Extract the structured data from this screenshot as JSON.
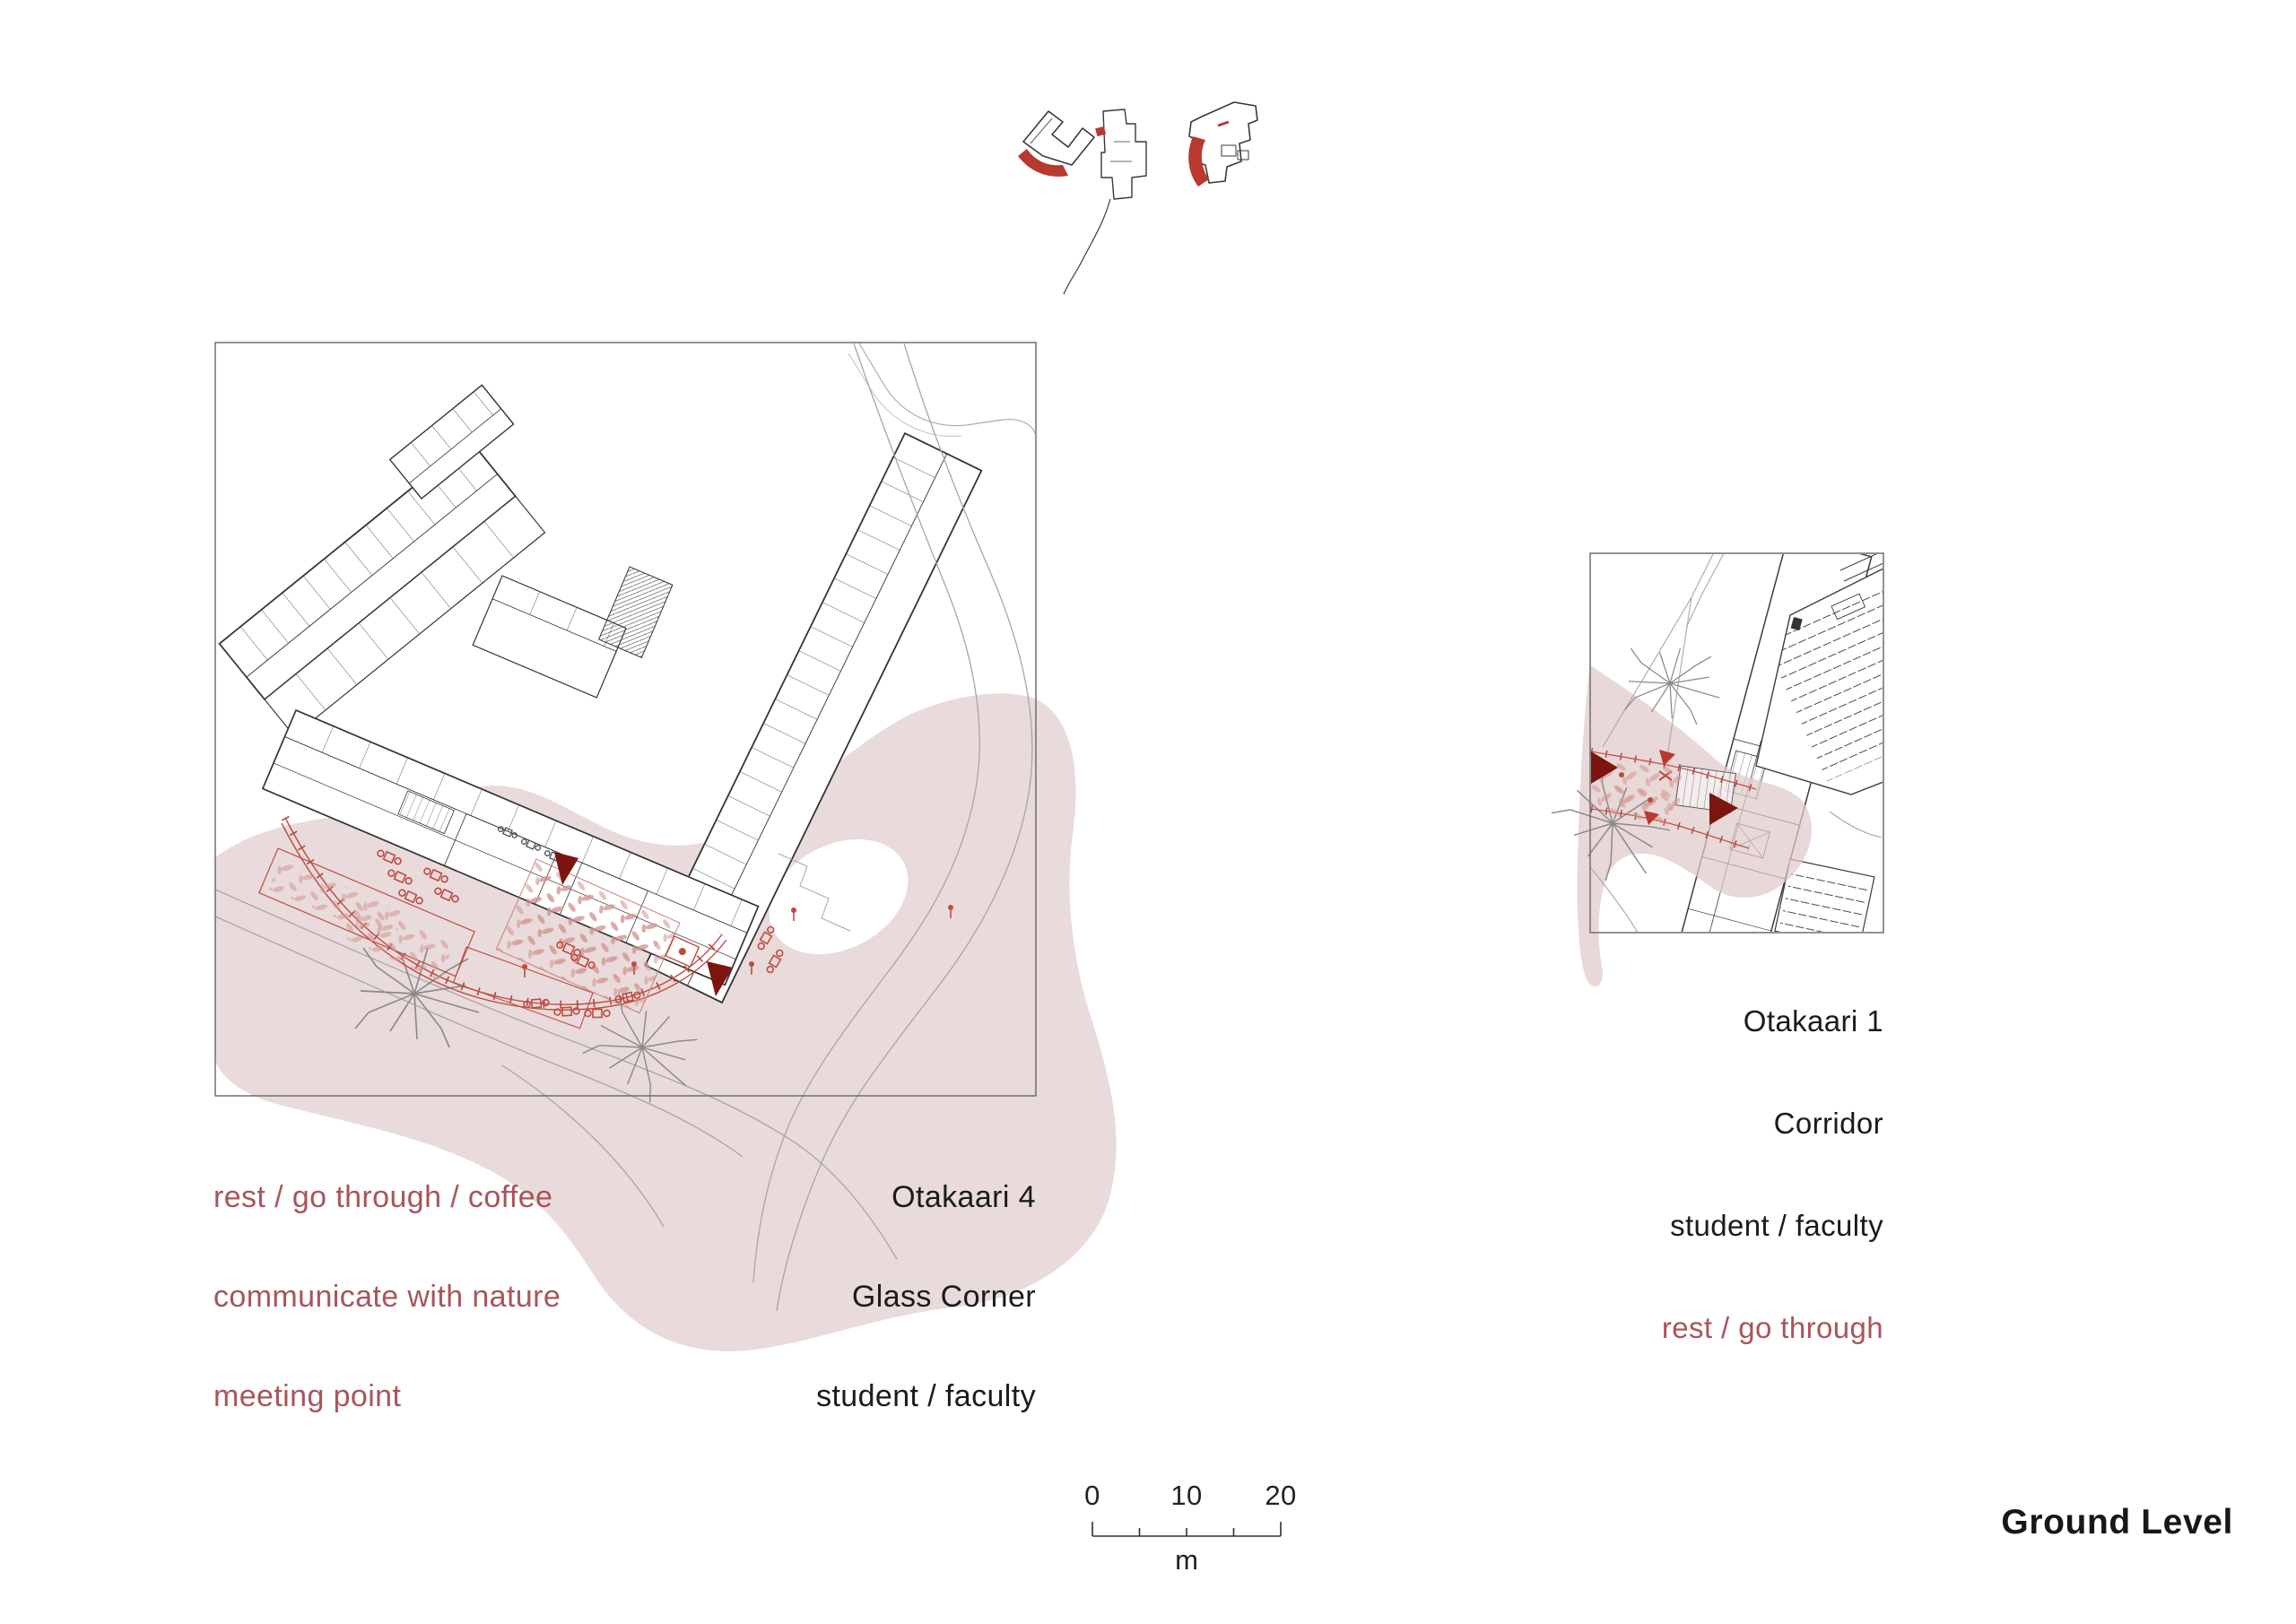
{
  "sheet": {
    "level_label": "Ground Level"
  },
  "plan_otakaari4": {
    "title": "Otakaari 4",
    "space": "Glass Corner",
    "users": "student / faculty",
    "activities": [
      "rest / go through / coffee",
      "communicate with nature",
      "meeting point"
    ]
  },
  "plan_otakaari1": {
    "title": "Otakaari 1",
    "space": "Corridor",
    "users": "student / faculty",
    "activities": [
      "rest / go through"
    ]
  },
  "scale_bar": {
    "tick_labels": [
      "0",
      "10",
      "20"
    ],
    "unit_label": "m"
  },
  "site_key": {
    "icons": [
      "site-footprint-otakaari-4",
      "site-footprint-campus-building",
      "site-footprint-otakaari-1"
    ],
    "highlight_color": "#b9392e"
  },
  "colors": {
    "zone_pink": "#e9dbdb",
    "path_red": "#c04a40",
    "highlight_red": "#b9392e",
    "view_cone_dark_red": "#7c150f",
    "activity_text": "#a8555a",
    "label_text": "#1b1b1b",
    "plan_line": "#3b3b3b",
    "site_line": "#a8a8a8",
    "frame_border": "#6f6f6f"
  }
}
